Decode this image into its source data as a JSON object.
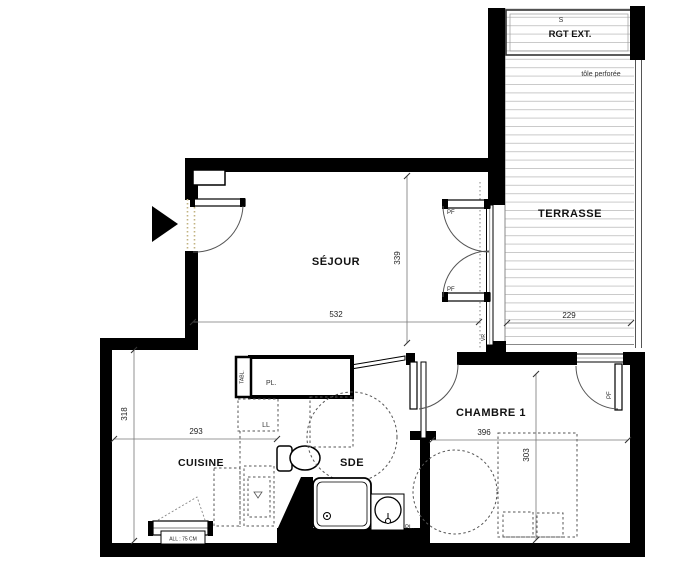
{
  "rooms": {
    "sejour": {
      "label": "SÉJOUR",
      "width": "532",
      "depth": "339"
    },
    "terrasse": {
      "label": "TERRASSE",
      "width": "229"
    },
    "rgt": {
      "label": "RGT EXT.",
      "symbol": "S",
      "note": "tôle perforée"
    },
    "cuisine": {
      "label": "CUISINE",
      "width": "293",
      "depth": "318",
      "window_note": "ALL : 75 CM"
    },
    "sde": {
      "label": "SDE",
      "closet": "PL.",
      "washer": "LL",
      "panel": "TABL."
    },
    "chambre": {
      "label": "CHAMBRE 1",
      "width": "396",
      "depth": "303",
      "closet": "PL."
    }
  },
  "openings": {
    "pf_sejour_top": "PF",
    "pf_sejour_bottom": "PF",
    "pf_chambre": "PF",
    "shutter": "VR"
  },
  "colors": {
    "wall": "#000000",
    "deck_line": "#c9c9c9",
    "threshold_dots": "#c2b280"
  }
}
